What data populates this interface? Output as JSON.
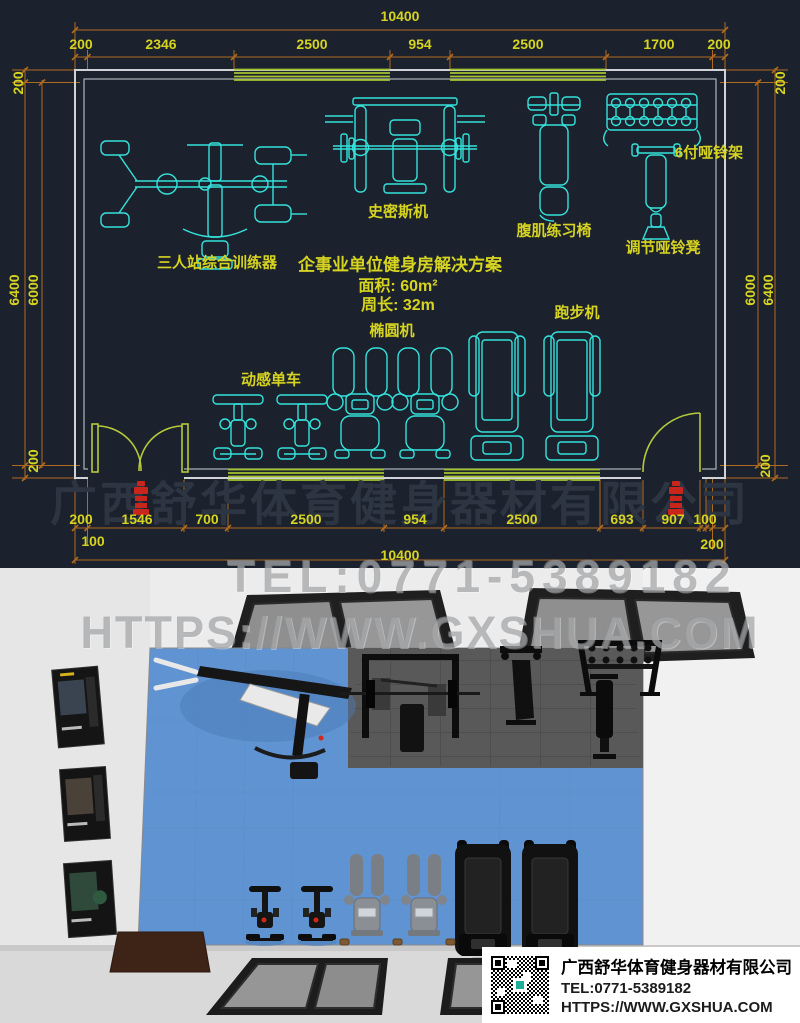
{
  "colors": {
    "cad_background": "#1b222d",
    "equipment_cyan": "#35e2dc",
    "label_yellow": "#d6d321",
    "dimension_orange": "#b06a1e",
    "window_green": "#a4c42f",
    "wall_gray": "#cfd3d8",
    "door_green": "#b5c93a",
    "stamp_red": "#c8251c",
    "render_background": "#ebebeb",
    "floor_blue": "#6093d1",
    "mat_gray": "#595959",
    "watermark_gray": "#929598"
  },
  "cad": {
    "dims": {
      "total": "10400",
      "top_segments": [
        "200",
        "2346",
        "2500",
        "954",
        "2500",
        "1700",
        "200"
      ],
      "side_top_left": "200",
      "side_top_right": "200",
      "left_outer": "6400",
      "left_inner": "6000",
      "right_inner": "6000",
      "right_outer": "6400",
      "side_bottom_left": "200",
      "side_bottom_right": "200",
      "bottom_segments": [
        "200",
        "1546",
        "700",
        "2500",
        "954",
        "2500",
        "693",
        "907",
        "100"
      ],
      "bottom_sub_left": "100",
      "bottom_sub_right": "200",
      "bottom_total": "10400"
    },
    "equipment_labels": {
      "multi_station": "三人站综合训练器",
      "smith_machine": "史密斯机",
      "ab_chair": "腹肌练习椅",
      "dumbbell_rack": "6付哑铃架",
      "adjustable_bench": "调节哑铃凳",
      "spin_bike": "动感单车",
      "elliptical": "椭圆机",
      "treadmill": "跑步机"
    },
    "solution": {
      "title": "企事业单位健身房解决方案",
      "area": "面积: 60m²",
      "perimeter": "周长: 32m"
    }
  },
  "watermarks": {
    "company": "广西舒华体育健身器材有限公司",
    "tel": "TEL:0771-5389182",
    "url": "HTTPS://WWW.GXSHUA.COM"
  },
  "info_box": {
    "company": "广西舒华体育健身器材有限公司",
    "tel": "TEL:0771-5389182",
    "url": "HTTPS://WWW.GXSHUA.COM"
  }
}
